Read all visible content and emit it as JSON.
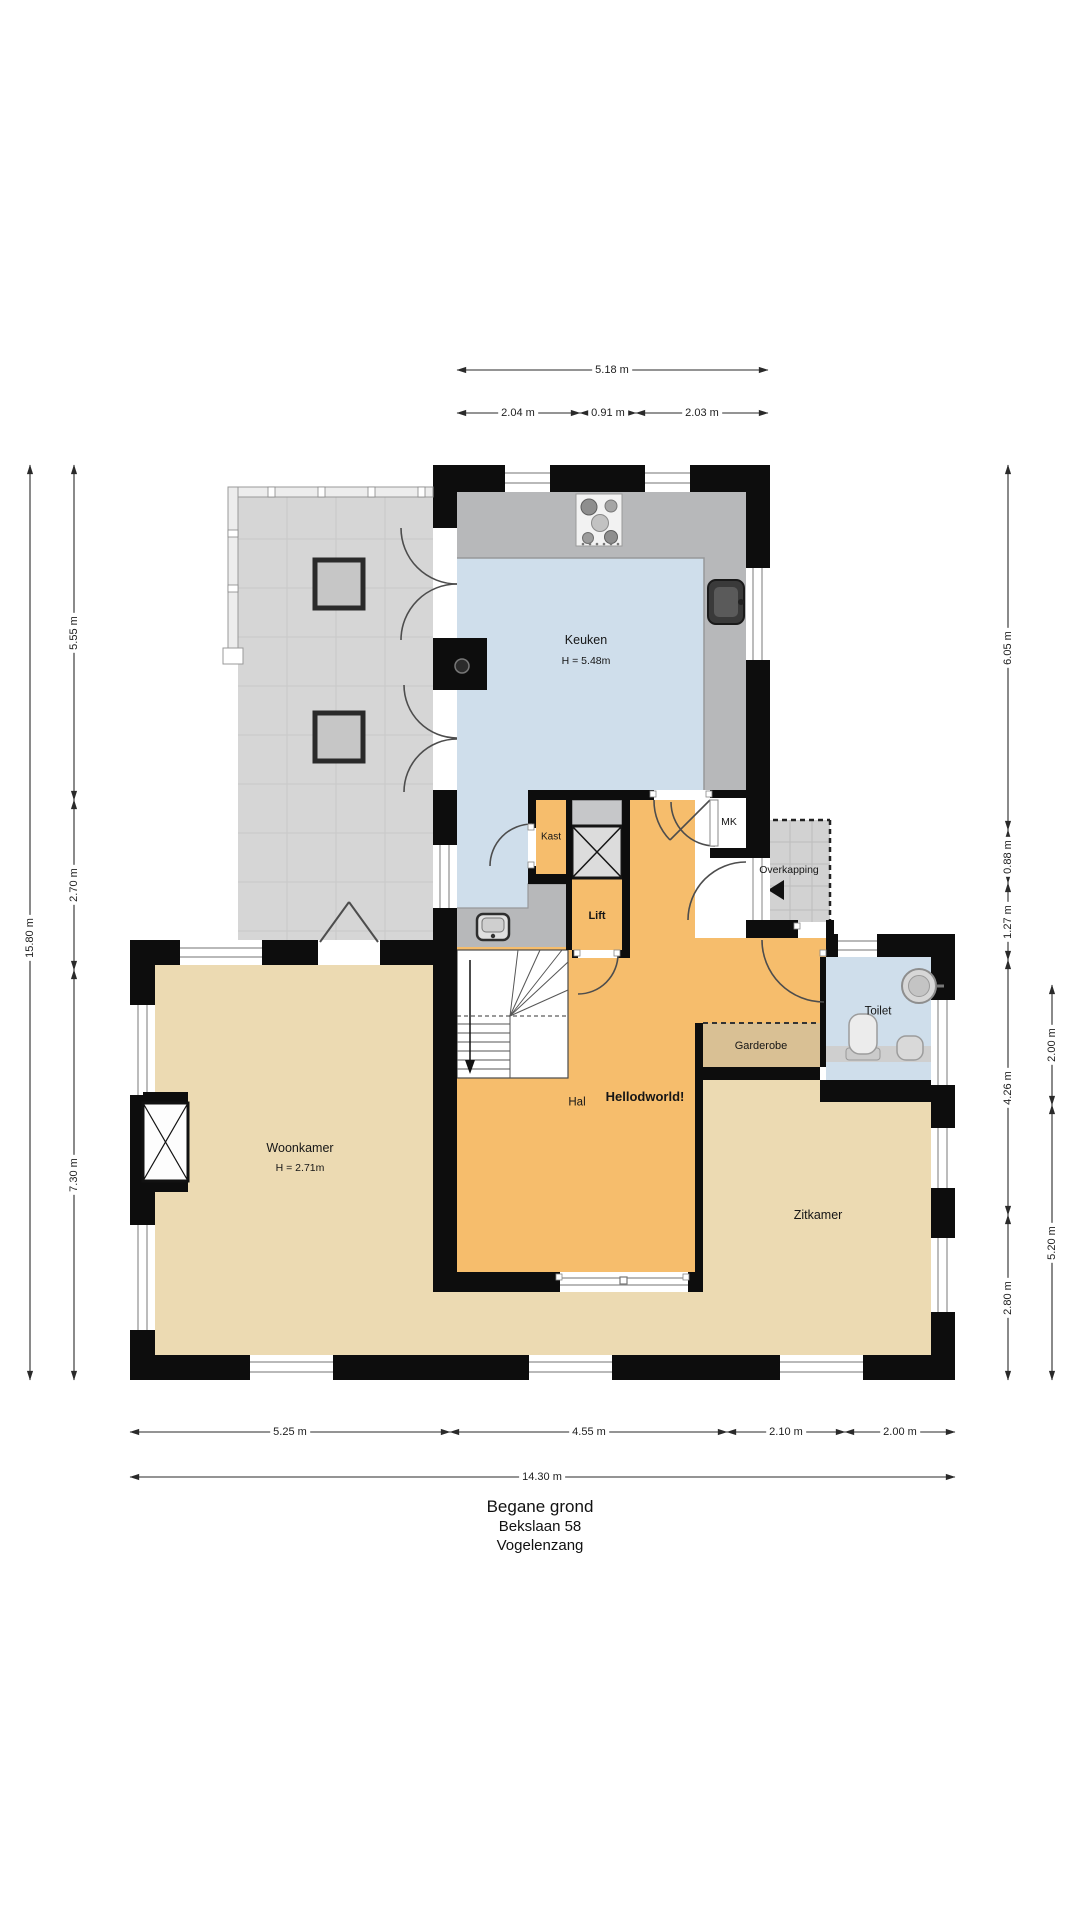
{
  "floorplan": {
    "title_lines": [
      "Begane grond",
      "Bekslaan 58",
      "Vogelenzang"
    ],
    "rooms": {
      "keuken": {
        "label": "Keuken",
        "height": "H = 5.48m"
      },
      "woonkamer": {
        "label": "Woonkamer",
        "height": "H = 2.71m"
      },
      "zitkamer": {
        "label": "Zitkamer"
      },
      "hal": {
        "label": "Hal",
        "note": "Hellodworld!"
      },
      "kast": {
        "label": "Kast"
      },
      "lift": {
        "label": "Lift"
      },
      "mk": {
        "label": "MK"
      },
      "overkapping": {
        "label": "Overkapping"
      },
      "toilet": {
        "label": "Toilet"
      },
      "garderobe": {
        "label": "Garderobe"
      }
    },
    "dimensions": {
      "top": {
        "total": "5.18 m",
        "segments": [
          "2.04 m",
          "0.91 m",
          "2.03 m"
        ]
      },
      "left": {
        "total": "15.80 m",
        "segments": [
          "5.55 m",
          "2.70 m",
          "7.30 m"
        ]
      },
      "right_inner": {
        "segments": [
          "6.05 m",
          "0.88 m",
          "1.27 m",
          "4.26 m",
          "2.80 m"
        ]
      },
      "right_outer": {
        "segments": [
          "2.00 m",
          "5.20 m"
        ]
      },
      "bottom": {
        "total": "14.30 m",
        "segments": [
          "5.25 m",
          "4.55 m",
          "2.10 m",
          "2.00 m"
        ]
      }
    },
    "colors": {
      "wall": "#0d0d0d",
      "kitchen_floor": "#cfdeeb",
      "toilet_floor": "#cfdeeb",
      "hal_floor": "#f6bd6c",
      "living_floor": "#ecdab2",
      "garderobe_floor": "#d9c094",
      "terrace_floor": "#d6d6d6",
      "overkapping_floor": "#d2d2d2",
      "counter": "#b7b8ba"
    }
  }
}
